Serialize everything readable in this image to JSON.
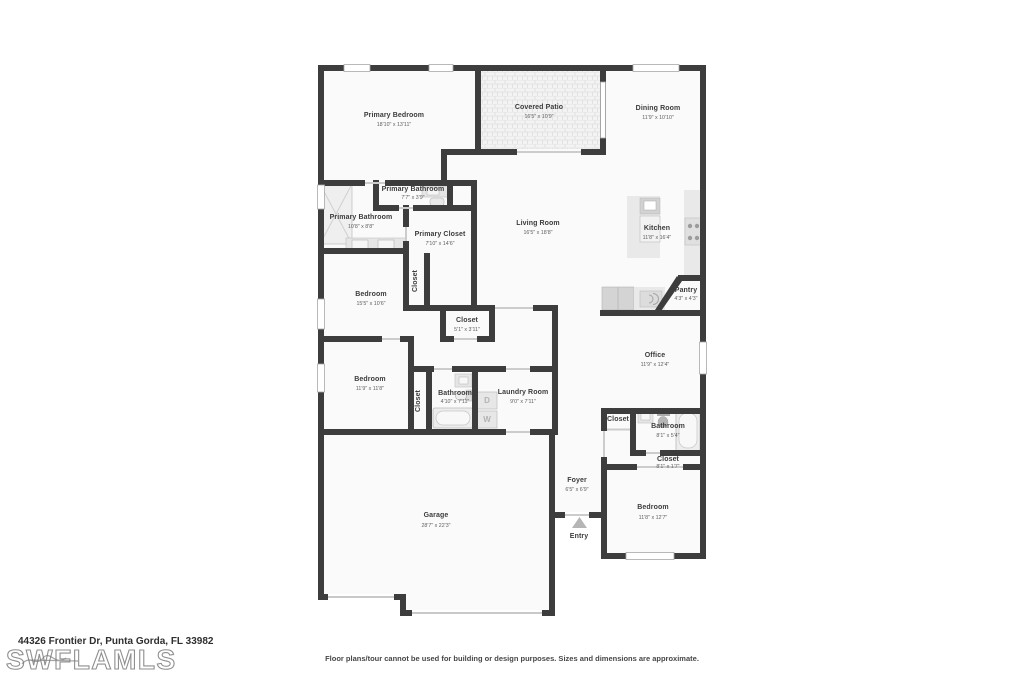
{
  "footer": {
    "address": "44326 Frontier Dr, Punta Gorda, FL 33982",
    "watermark": "SWFLAMLS",
    "disclaimer": "Floor plans/tour cannot be used for building or design purposes. Sizes and dimensions are approximate."
  },
  "colors": {
    "wall": "#3d3d3d",
    "room_fill": "#fafafa",
    "fixture": "#e8e8e8",
    "door_line": "#cccccc",
    "label": "#3c3c3c",
    "dims": "#5f5f5f",
    "watermark_outline": "#8f8f8f"
  },
  "appliances": {
    "dryer": "D",
    "washer": "W"
  },
  "rooms": [
    {
      "name": "Primary Bedroom",
      "dims": "18'10\" x 13'11\""
    },
    {
      "name": "Covered Patio",
      "dims": "16'5\" x 10'9\""
    },
    {
      "name": "Dining Room",
      "dims": "11'9\" x 10'10\""
    },
    {
      "name": "Primary Bathroom",
      "dims": "7'7\" x 3'9\""
    },
    {
      "name": "Primary Bathroom",
      "dims": "10'8\" x 8'8\""
    },
    {
      "name": "Primary Closet",
      "dims": "7'10\" x 14'6\""
    },
    {
      "name": "Living Room",
      "dims": "16'5\" x 18'8\""
    },
    {
      "name": "Kitchen",
      "dims": "11'8\" x 16'4\""
    },
    {
      "name": "Pantry",
      "dims": "4'3\" x 4'3\""
    },
    {
      "name": "Bedroom",
      "dims": "15'5\" x 10'6\""
    },
    {
      "name": "Closet",
      "dims": ""
    },
    {
      "name": "Closet",
      "dims": "5'1\" x 3'11\""
    },
    {
      "name": "Office",
      "dims": "11'9\" x 12'4\""
    },
    {
      "name": "Bedroom",
      "dims": "11'9\" x 11'8\""
    },
    {
      "name": "Closet",
      "dims": ""
    },
    {
      "name": "Bathroom",
      "dims": "4'10\" x 7'11\""
    },
    {
      "name": "Laundry Room",
      "dims": "9'0\" x 7'11\""
    },
    {
      "name": "Closet",
      "dims": ""
    },
    {
      "name": "Bathroom",
      "dims": "8'1\" x 5'4\""
    },
    {
      "name": "Closet",
      "dims": "8'1\" x 1'7\""
    },
    {
      "name": "Foyer",
      "dims": "6'5\" x 6'9\""
    },
    {
      "name": "Garage",
      "dims": "28'7\" x 22'3\""
    },
    {
      "name": "Bedroom",
      "dims": "11'8\" x 12'7\""
    },
    {
      "name": "Entry",
      "dims": ""
    }
  ]
}
